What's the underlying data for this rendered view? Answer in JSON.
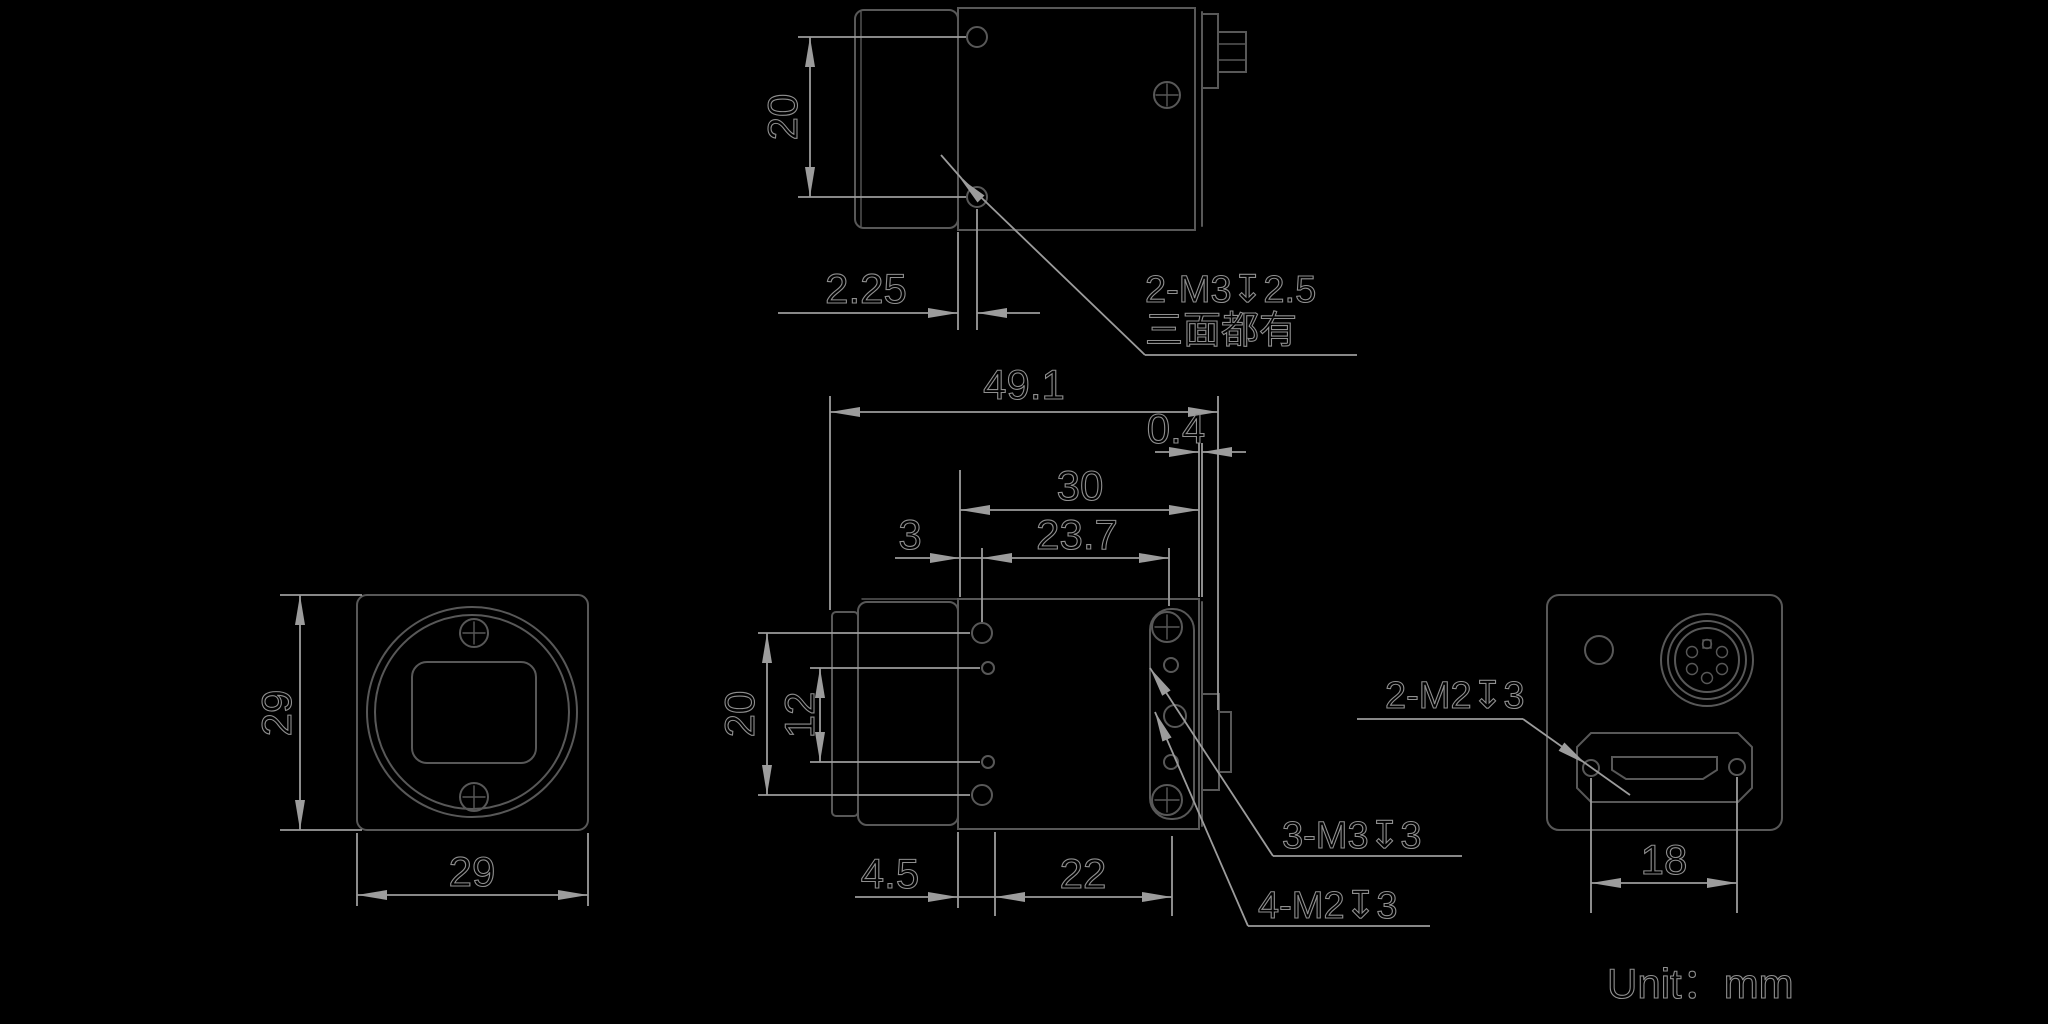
{
  "drawing": {
    "unit_label": "Unit：mm",
    "views": {
      "top": {
        "dim_hole_spacing": "20",
        "dim_hole_to_face": "2.25",
        "note_thread_line1": "2-M3↧2.5",
        "note_thread_line2": "三面都有"
      },
      "side": {
        "dim_overall_length": "49.1",
        "dim_back_gap": "0.4",
        "dim_back_span": "30",
        "dim_hole_span": "23.7",
        "dim_front_hole_offset": "3",
        "dim_side_hole_spacing": "20",
        "dim_side_inner_spacing": "12",
        "dim_bottom_offset": "4.5",
        "dim_bottom_span": "22",
        "note_m3_thread": "3-M3↧3",
        "note_m2_thread": "4-M2↧3"
      },
      "front": {
        "dim_height": "29",
        "dim_width": "29"
      },
      "back": {
        "note_m2_thread": "2-M2↧3",
        "dim_connector_screw_span": "18"
      }
    }
  },
  "colors": {
    "background": "#000000",
    "object-line": "#585858",
    "dim-line": "#9c9c9c",
    "text-line": "#8f8f8f"
  }
}
